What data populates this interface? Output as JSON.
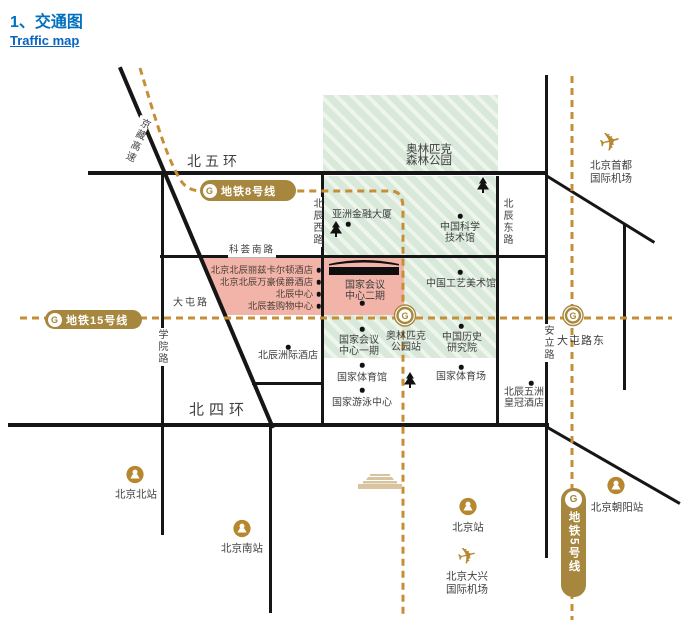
{
  "title": {
    "heading": "1、交通图",
    "link": "Traffic map"
  },
  "colors": {
    "title_blue": "#0070C0",
    "link_blue": "#0563C1",
    "metro_gold": "#A6873D",
    "dash_gold": "#C68F35",
    "station_gold": "#B6872E",
    "park_green": "#DCEBDB",
    "block_pink": "#F2B3A8",
    "road_black": "#161616",
    "label_text": "#3F3F3F",
    "tiananmen_tan": "#D8C5A0"
  },
  "map": {
    "road_labels": [
      {
        "label": "北五环",
        "x": 214,
        "y": 162,
        "fs": 14,
        "ls": 4
      },
      {
        "label": "北四环",
        "x": 219,
        "y": 411,
        "fs": 15,
        "ls": 5
      },
      {
        "label": "科荟南路",
        "x": 252,
        "y": 251,
        "fs": 9.5,
        "ls": 2,
        "bg": 1
      },
      {
        "label": "大屯路",
        "x": 191,
        "y": 303,
        "fs": 10,
        "ls": 2
      },
      {
        "label": "大屯路东",
        "x": 581,
        "y": 341,
        "fs": 11,
        "ls": 1
      },
      {
        "label": "学院路",
        "x": 161,
        "y": 347,
        "fs": 10,
        "v": 1,
        "bg": 1
      },
      {
        "label": "北辰西路",
        "x": 316,
        "y": 222,
        "fs": 10,
        "v": 1,
        "bg": 1
      },
      {
        "label": "北辰东路",
        "x": 506,
        "y": 222,
        "fs": 10,
        "v": 1,
        "bg": 1
      },
      {
        "label": "安立路",
        "x": 547,
        "y": 343,
        "fs": 10,
        "v": 1,
        "bg": 1
      },
      {
        "label": "京藏高速",
        "x": 136,
        "y": 140,
        "fs": 10,
        "v": 1,
        "rot": 24,
        "bg": 1
      }
    ],
    "pois": [
      {
        "label": "奥林匹克\n森林公园",
        "x": 429,
        "y": 156,
        "fs": 11.5
      },
      {
        "label": "亚洲金融大厦",
        "x": 362,
        "y": 215,
        "dot": [
          348,
          224
        ]
      },
      {
        "label": "中国科学\n技术馆",
        "x": 460,
        "y": 233,
        "dot": [
          460,
          216
        ]
      },
      {
        "label": "中国工艺美术馆",
        "x": 461,
        "y": 284,
        "dot": [
          460,
          272
        ]
      },
      {
        "label": "中国历史\n研究院",
        "x": 462,
        "y": 343,
        "dot": [
          461,
          326
        ]
      },
      {
        "label": "国家会议\n中心二期",
        "x": 365,
        "y": 291,
        "dot": [
          362,
          303
        ]
      },
      {
        "label": "国家会议\n中心一期",
        "x": 359,
        "y": 346,
        "dot": [
          362,
          329
        ]
      },
      {
        "label": "奥林匹克\n公园站",
        "x": 406,
        "y": 342
      },
      {
        "label": "国家体育馆",
        "x": 362,
        "y": 378,
        "dot": [
          362,
          365
        ]
      },
      {
        "label": "国家体育场",
        "x": 461,
        "y": 377,
        "dot": [
          461,
          367
        ]
      },
      {
        "label": "国家游泳中心",
        "x": 362,
        "y": 403,
        "dot": [
          362,
          390
        ]
      },
      {
        "label": "北辰五洲\n皇冠酒店",
        "x": 524,
        "y": 398,
        "dot": [
          531,
          383
        ]
      },
      {
        "label": "北辰洲际酒店",
        "x": 288,
        "y": 356,
        "dot": [
          288,
          347
        ]
      }
    ],
    "hotels": [
      {
        "label": "北京北辰丽兹卡尔顿酒店",
        "y": 270
      },
      {
        "label": "北京北辰万豪侯爵酒店",
        "y": 282
      },
      {
        "label": "北辰中心",
        "y": 294
      },
      {
        "label": "北辰荟购物中心",
        "y": 306
      }
    ],
    "stations": [
      {
        "label": "北京北站",
        "x": 136,
        "y": 495,
        "type": "rail",
        "ix": 135,
        "iy": 477
      },
      {
        "label": "北京南站",
        "x": 242,
        "y": 549,
        "type": "rail",
        "ix": 242,
        "iy": 531
      },
      {
        "label": "北京站",
        "x": 468,
        "y": 528,
        "type": "rail",
        "ix": 468,
        "iy": 509
      },
      {
        "label": "北京朝阳站",
        "x": 617,
        "y": 508,
        "type": "rail",
        "ix": 616,
        "iy": 488
      },
      {
        "label": "北京首都\n国际机场",
        "x": 611,
        "y": 172,
        "type": "air",
        "ix": 610,
        "iy": 142,
        "ps": 26
      },
      {
        "label": "北京大兴\n国际机场",
        "x": 467,
        "y": 583,
        "type": "air",
        "ix": 467,
        "iy": 556,
        "ps": 23
      }
    ],
    "metro_badges": [
      {
        "label": "地铁8号线",
        "x": 200,
        "y": 180,
        "w": 93,
        "h": 21,
        "dir": "h"
      },
      {
        "label": "地铁15号线",
        "x": 45,
        "y": 310,
        "w": 94,
        "h": 19,
        "dir": "h"
      },
      {
        "label": "地铁5号线",
        "x": 561,
        "y": 488,
        "w": 25,
        "h": 106,
        "dir": "v"
      }
    ],
    "metro_interchanges": [
      {
        "name": "olympic-park-station",
        "x": 405,
        "y": 318,
        "r": 10.5
      },
      {
        "name": "datun-road-east-station",
        "x": 573,
        "y": 318,
        "r": 10
      }
    ],
    "trees": [
      [
        336,
        242
      ],
      [
        483,
        198
      ],
      [
        410,
        393
      ]
    ],
    "landmark_tiananmen": {
      "x": 357,
      "y": 470
    }
  }
}
